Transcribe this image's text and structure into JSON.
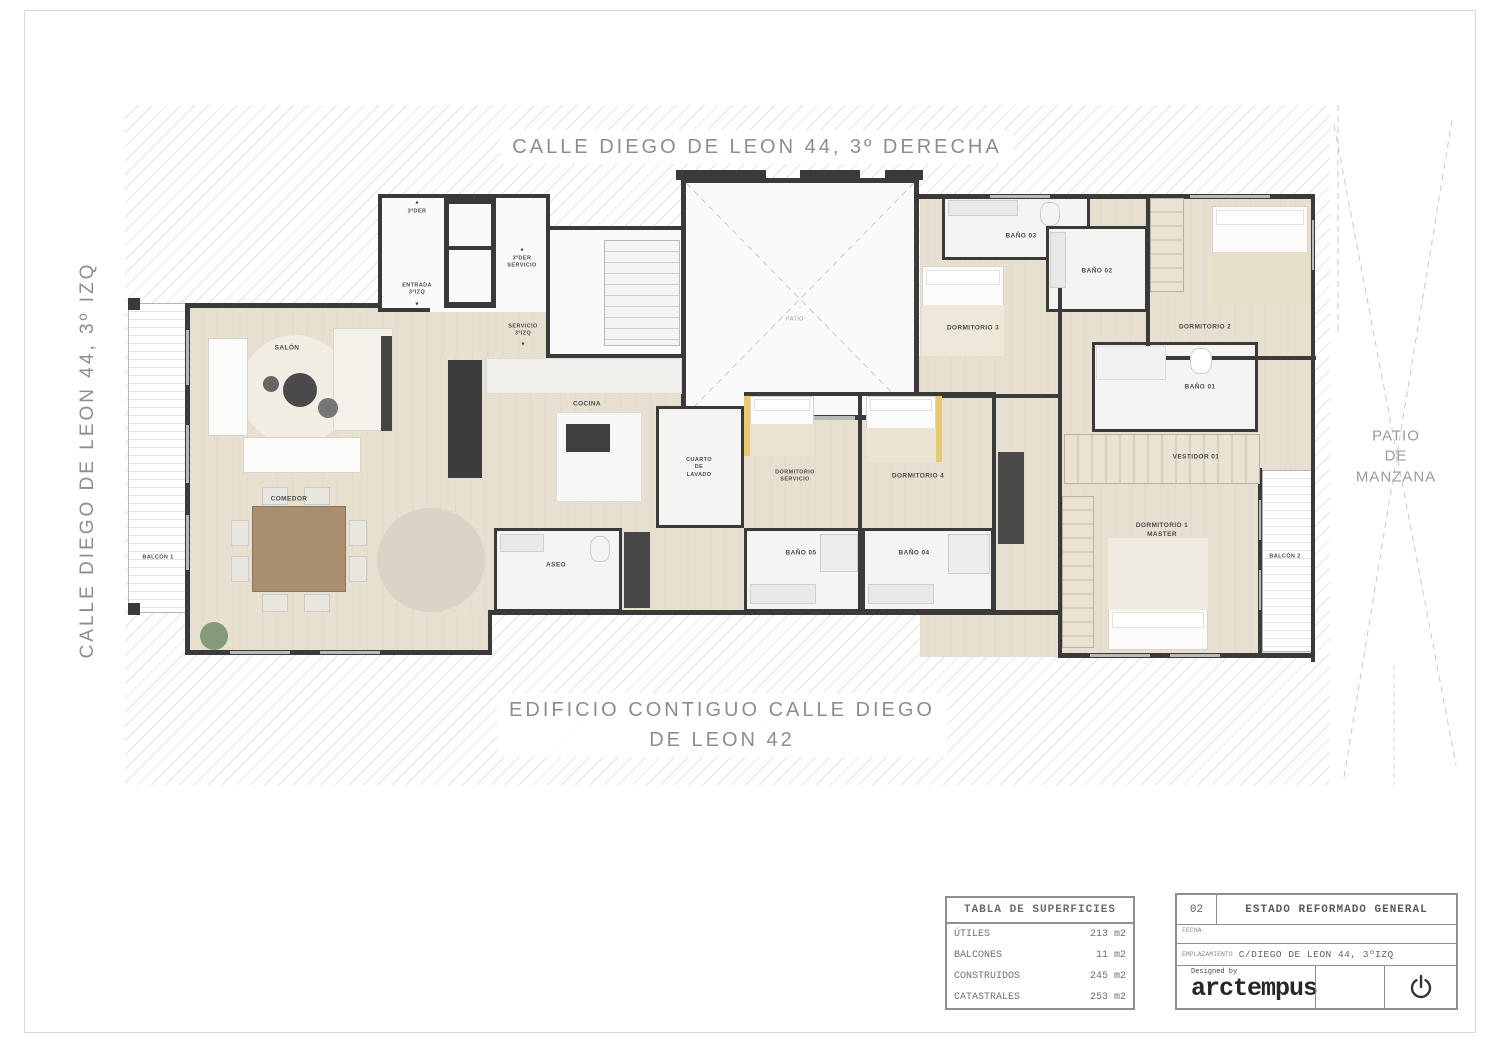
{
  "street_labels": {
    "top": "CALLE DIEGO DE LEON 44, 3º DERECHA",
    "left": "CALLE DIEGO DE LEON 44, 3º IZQ",
    "bottom": "EDIFICIO CONTIGUO CALLE DIEGO\nDE LEON 42",
    "right": "PATIO\nDE MANZANA"
  },
  "rooms": {
    "salon": "SALÓN",
    "comedor": "COMEDOR",
    "balcon1": "BALCÓN 1",
    "balcon2": "BALCÓN 2",
    "cocina": "COCINA",
    "aseo": "ASEO",
    "patio": "PATIO",
    "cuarto_lavado": "CUARTO\nDE\nLAVADO",
    "dormitorio_servicio": "DORMITORIO\nSERVICIO",
    "dormitorio_4": "DORMITORIO 4",
    "bano_05": "BAÑO 05",
    "bano_04": "BAÑO 04",
    "dormitorio_3": "DORMITORIO 3",
    "bano_03": "BAÑO 03",
    "bano_02": "BAÑO 02",
    "dormitorio_2": "DORMITORIO 2",
    "bano_01": "BAÑO 01",
    "vestidor_01": "VESTIDOR 01",
    "dormitorio_1": "DORMITORIO 1\nMASTER"
  },
  "entries": {
    "acceso_der": "3ºDER",
    "entrada_izq": "ENTRADA\n3ºIZQ",
    "servicio_der": "3ºDER\nSERVICIO",
    "servicio_izq": "SERVICIO\n3ºIZQ"
  },
  "icons": {
    "arrow_up": "▲",
    "arrow_down": "▼"
  },
  "surface_table": {
    "title": "TABLA DE SUPERFICIES",
    "rows": [
      {
        "label": "ÚTILES",
        "value": "213 m2"
      },
      {
        "label": "BALCONES",
        "value": "11 m2"
      },
      {
        "label": "CONSTRUIDOS",
        "value": "245 m2"
      },
      {
        "label": "CATASTRALES",
        "value": "253 m2"
      }
    ]
  },
  "title_block": {
    "sheet_number": "02",
    "sheet_title": "ESTADO REFORMADO GENERAL",
    "fecha_label": "FECHA",
    "emplazamiento_label": "EMPLAZAMIENTO",
    "emplazamiento_value": "C/DIEGO DE LEON 44, 3ºIZQ",
    "designed_by": "Designed by",
    "brand": "arctempus"
  },
  "colors": {
    "wall": "#3a3a3a",
    "floor": "#e7e0d1",
    "hatch_line": "#e2e2e2",
    "label_text": "#4c4c4c",
    "street_text": "#8d8d8d"
  }
}
